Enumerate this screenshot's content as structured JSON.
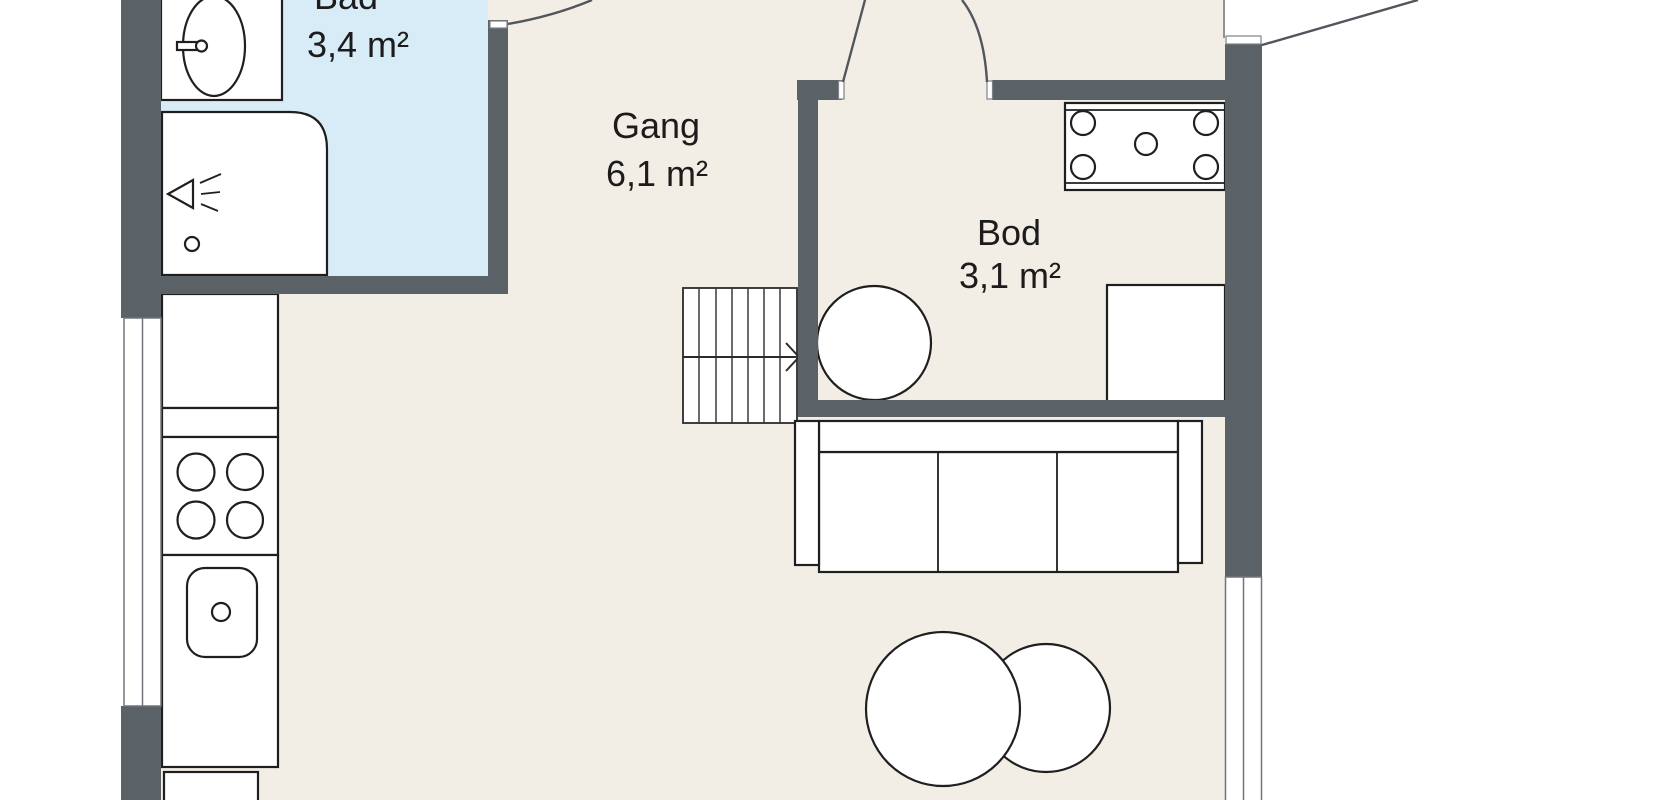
{
  "plan_title": "Apartment floor plan",
  "rooms": {
    "bathroom": {
      "name": "Bad",
      "area": "3,4 m²"
    },
    "hallway": {
      "name": "Gang",
      "area": "6,1 m²"
    },
    "storage": {
      "name": "Bod",
      "area": "3,1 m²"
    }
  },
  "colors": {
    "background": "#ffffff",
    "floor": "#f3eee5",
    "bathroom_floor": "#d8ecf7",
    "wall": "#5a6167",
    "outline": "#1f1f1f"
  },
  "fixtures": [
    "washbasin-icon",
    "faucet-icon",
    "shower-cabin-icon",
    "shower-head-icon",
    "drain-icon",
    "kitchen-cabinet-icon",
    "cooktop-4-burners-icon",
    "kitchen-sink-icon",
    "staircase-icon",
    "stair-direction-arrow-icon",
    "double-door-icon",
    "door-swing-icon",
    "window-icon",
    "water-heater-icon",
    "storage-cabinet-icon",
    "sofa-icon",
    "round-table-icon"
  ]
}
